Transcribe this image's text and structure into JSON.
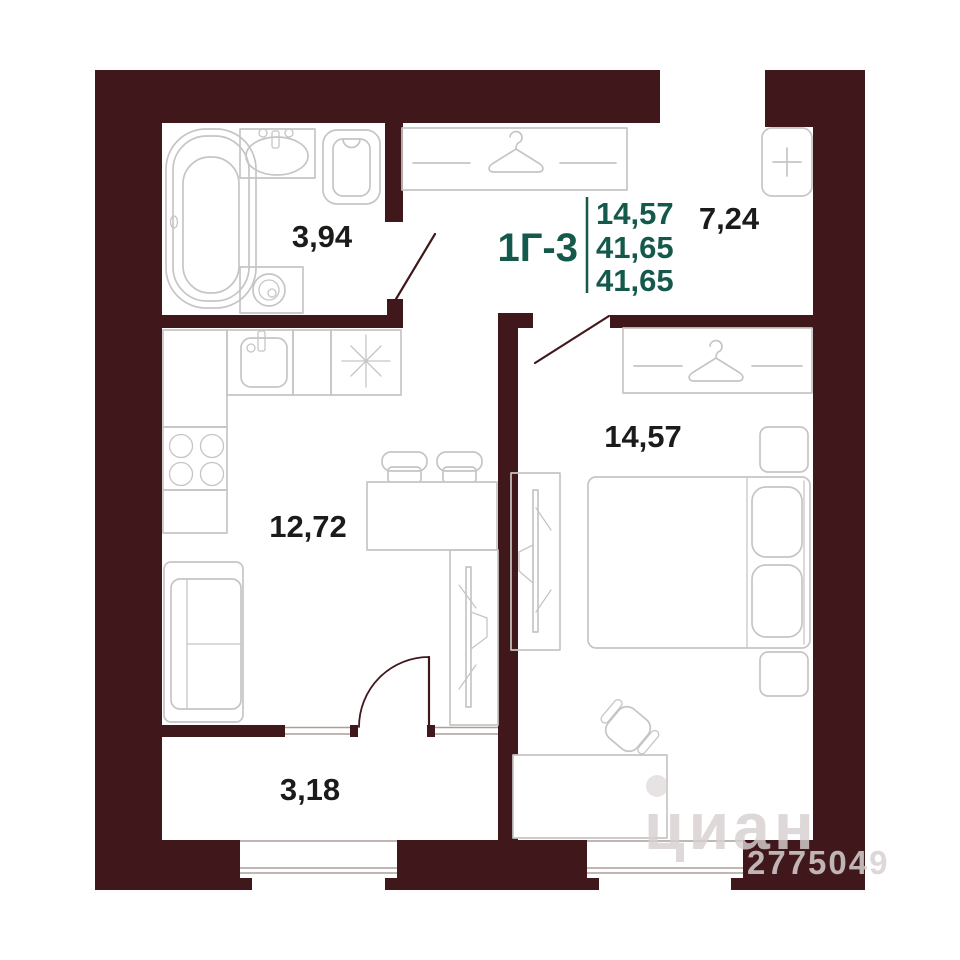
{
  "plan": {
    "unit": {
      "label": "1Г-3"
    },
    "stats": {
      "values": [
        "14,57",
        "41,65",
        "41,65"
      ]
    },
    "rooms": {
      "bathroom": {
        "area": "3,94"
      },
      "hallway": {
        "area": "7,24"
      },
      "bedroom": {
        "area": "14,57"
      },
      "kitchen_living": {
        "area": "12,72"
      },
      "balcony": {
        "area": "3,18"
      }
    },
    "watermark": {
      "brand": "циан",
      "id": "2775049"
    },
    "icons": {
      "wardrobe": "hanger-icon",
      "electrical_panel": "plus-icon",
      "hob": "sparkle-icon"
    },
    "colors": {
      "wall": "#40181C",
      "line": "#c6c5c4",
      "accent": "#14594B",
      "label": "#1b1b1a",
      "watermark": "#d7d0d0"
    }
  }
}
